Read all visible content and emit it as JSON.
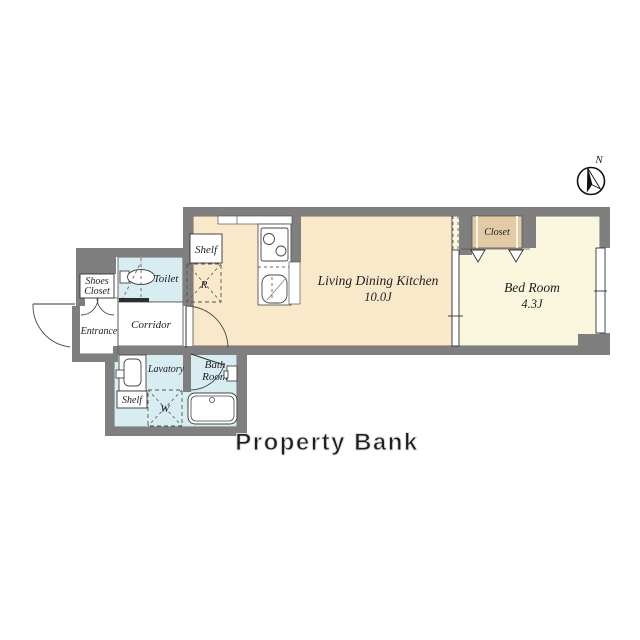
{
  "compass": {
    "label": "N"
  },
  "rooms": {
    "ldk": {
      "name": "Living Dining Kitchen",
      "size": "10.0J"
    },
    "bedroom": {
      "name": "Bed Room",
      "size": "4.3J",
      "closet": "Closet"
    },
    "toilet": {
      "name": "Toilet"
    },
    "shoes_closet": {
      "line1": "Shoes",
      "line2": "Closet"
    },
    "entrance": {
      "name": "Entrance"
    },
    "corridor": {
      "name": "Corridor"
    },
    "lavatory": {
      "name": "Lavatory",
      "shelf": "Shelf",
      "washer_label": "W"
    },
    "bath": {
      "line1": "Bath",
      "line2": "Room"
    },
    "kitchen": {
      "shelf": "Shelf",
      "refrigerator_label": "R"
    }
  },
  "watermark": {
    "text": "Property Bank"
  },
  "colors": {
    "wall": "#7f7f7f",
    "ldk_floor": "#fae8cb",
    "bedroom_floor": "#fbf7df",
    "closet_fill": "#e2cba4",
    "wet_floor": "#d8edf2",
    "outline": "#3a3a3a",
    "watermark": "#f4f4f4"
  }
}
